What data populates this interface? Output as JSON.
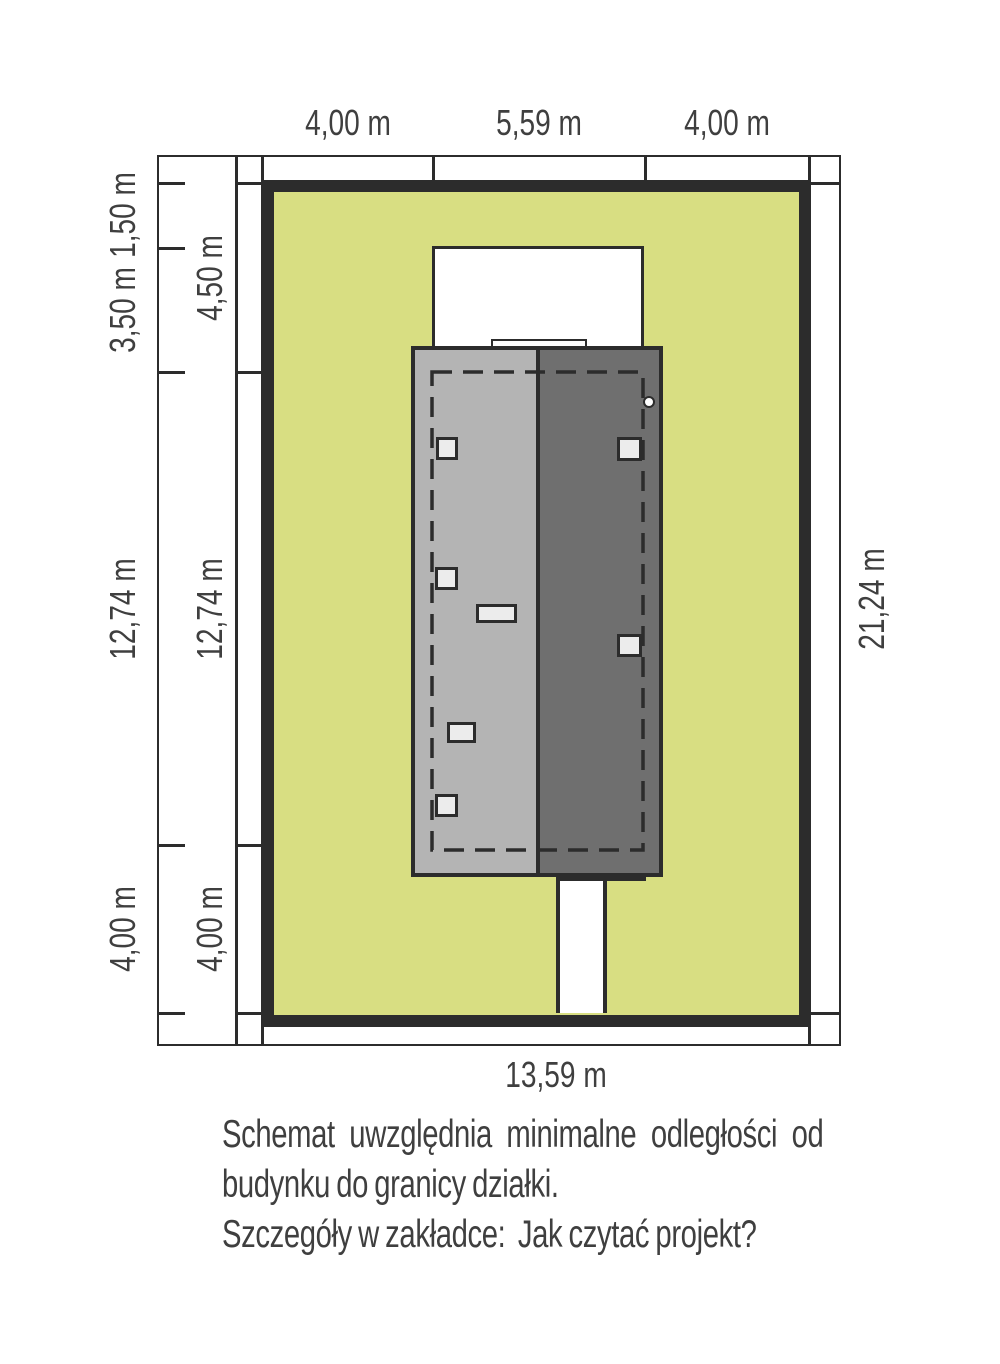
{
  "dimensions": {
    "top": [
      "4,00 m",
      "5,59 m",
      "4,00 m"
    ],
    "left_outer": [
      "1,50 m",
      "3,50 m",
      "12,74 m",
      "4,00 m"
    ],
    "left_inner": [
      "4,50 m",
      "12,74 m",
      "4,00 m"
    ],
    "right": "21,24 m",
    "bottom": "13,59 m"
  },
  "caption": {
    "line1": "Schemat uwzględnia minimalne odległości od",
    "line2": "budynku do granicy działki.",
    "line3": "Szczegóły w zakładce:  Jak czytać projekt?"
  },
  "colors": {
    "plot_green": "#d8de82",
    "roof_light": "#b4b4b4",
    "roof_dark": "#6f6f6f",
    "line_dark": "#2c2c2c",
    "window_fill": "#ececec",
    "text": "#3f3f3f"
  }
}
